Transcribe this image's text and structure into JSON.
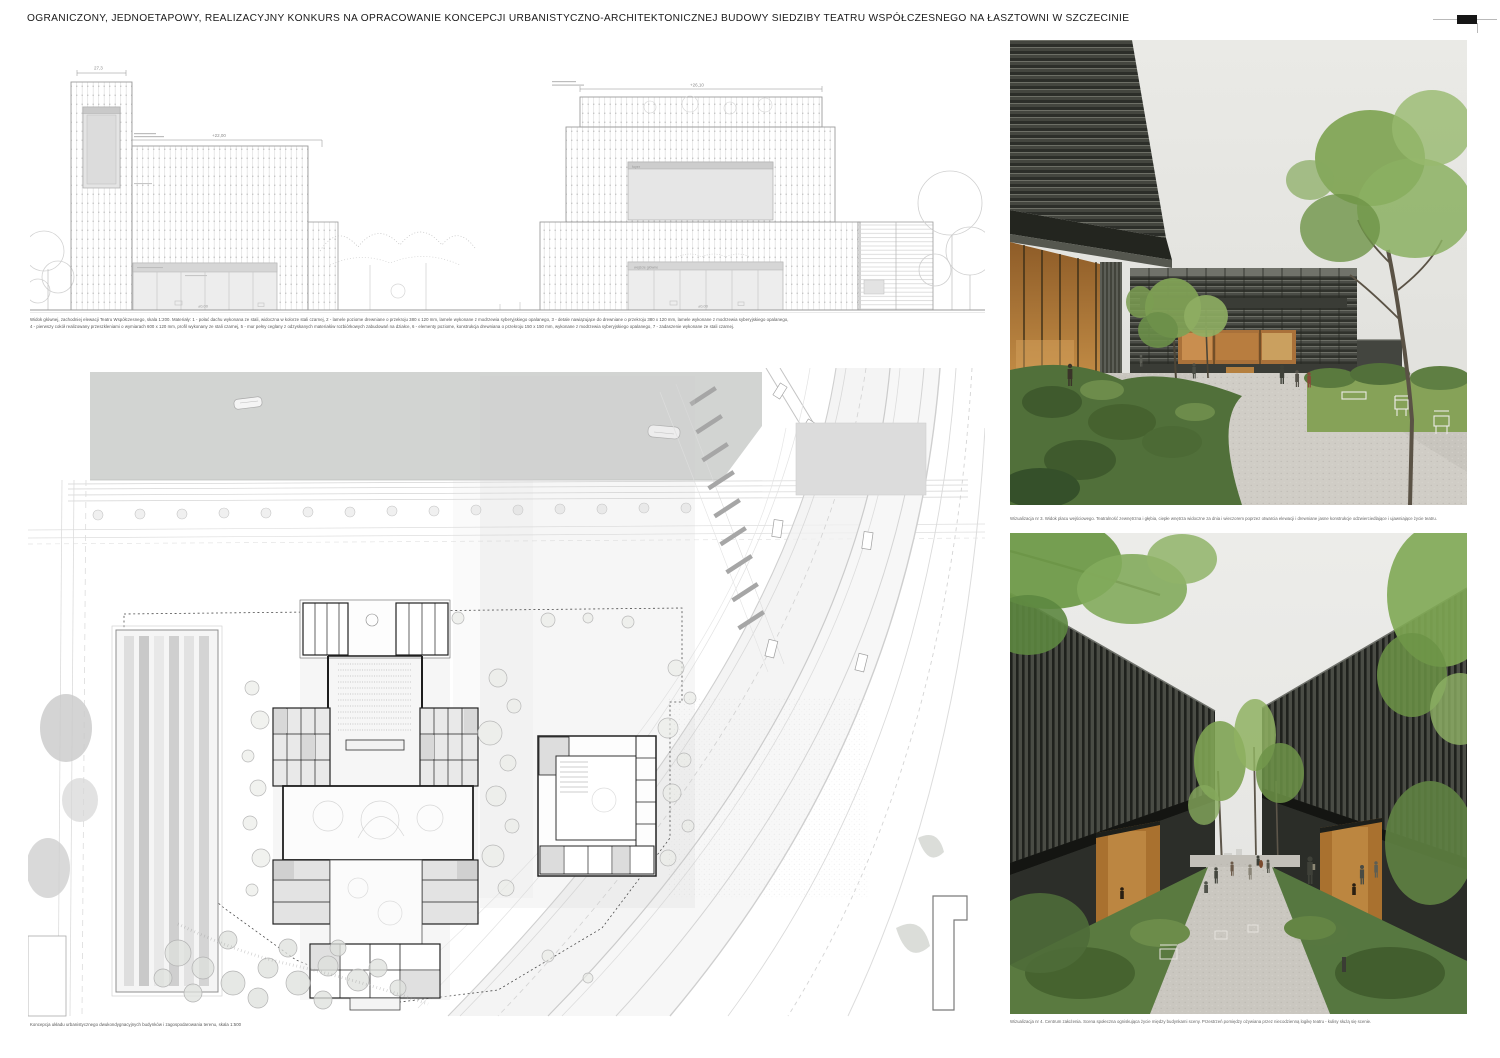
{
  "header": {
    "title": "OGRANICZONY, JEDNOETAPOWY, REALIZACYJNY KONKURS NA OPRACOWANIE KONCEPCJI URBANISTYCZNO-ARCHITEKTONICZNEJ BUDOWY SIEDZIBY TEATRU WSPÓŁCZESNEGO NA ŁASZTOWNI W SZCZECINIE"
  },
  "elevation": {
    "caption_line1": "Widok głównej, zachodniej elewacji Teatru Współczesnego, skala 1:200. Materiały: 1 - połać dachu wykonana ze stali, widoczna w kolorze stali czarnej, 2 - lamele poziome drewniane o przekroju 380 x 120 mm, lamele wykonane z modrzewia syberyjskiego opalanego, 3 - detale nawiązujące do drewniane o przekroju 380 x 120 mm, lamele wykonane z modrzewia syberyjskiego opalanego,",
    "caption_line2": "4 - pierwszy cokół realizowany przeszkleniami o wymiarach 600 x 120 mm, profil wykonany ze stali czarnej, 5 - mur pełny ceglany z odzyskanych materiałów rozbiórkowych zabudowań na działce, 6 - elementy poziome, konstrukcja drewniana o przekroju 150 x 150 mm, wykonane z modrzewia syberyjskiego opalanego, 7 - zadaszenie wykonane ze stali czarnej.",
    "annotations": {
      "tower_dim": "27,3",
      "left_level": "+22,00",
      "right_top_level": "+26,10",
      "panel_label": "foyer",
      "zero_left": "±0,00",
      "zero_right": "±0,00",
      "right_entrance_label": "wejście główne"
    }
  },
  "site_plan": {
    "caption": "Koncepcja układu urbanistycznego dwukondygnacyjnych budynków i zagospodarowania terenu, skala 1:500"
  },
  "photos": {
    "photo1": {
      "caption": "Wizualizacja nr 3. Widok placu wejściowego. Teatralność zewnętrzna i głębia, ciepłe wnętrza widoczne za dnia i wieczorem poprzez otwarcia elewacji i drewniane jasne konstrukcje odzwierciedlające i ujawniające życie teatru.",
      "sign": "TEATR WSPÓŁCZESNY"
    },
    "photo2": {
      "caption": "Wizualizacja nr 4. Centrum założenia. Scena społeczna ogniskująca życie między budynkami sceny. Przestrzeń pomiędzy ożywiana przez niecodzienną logikę teatru - kulisy służą się scenie."
    }
  },
  "colors": {
    "facade_dark": "#3b3d37",
    "wood_warm": "#a9713a",
    "foliage_green": "#7da24f",
    "gravel": "#c8c5be",
    "water_gray": "#d2d4d2",
    "drawing_line": "#9b9b9b"
  }
}
